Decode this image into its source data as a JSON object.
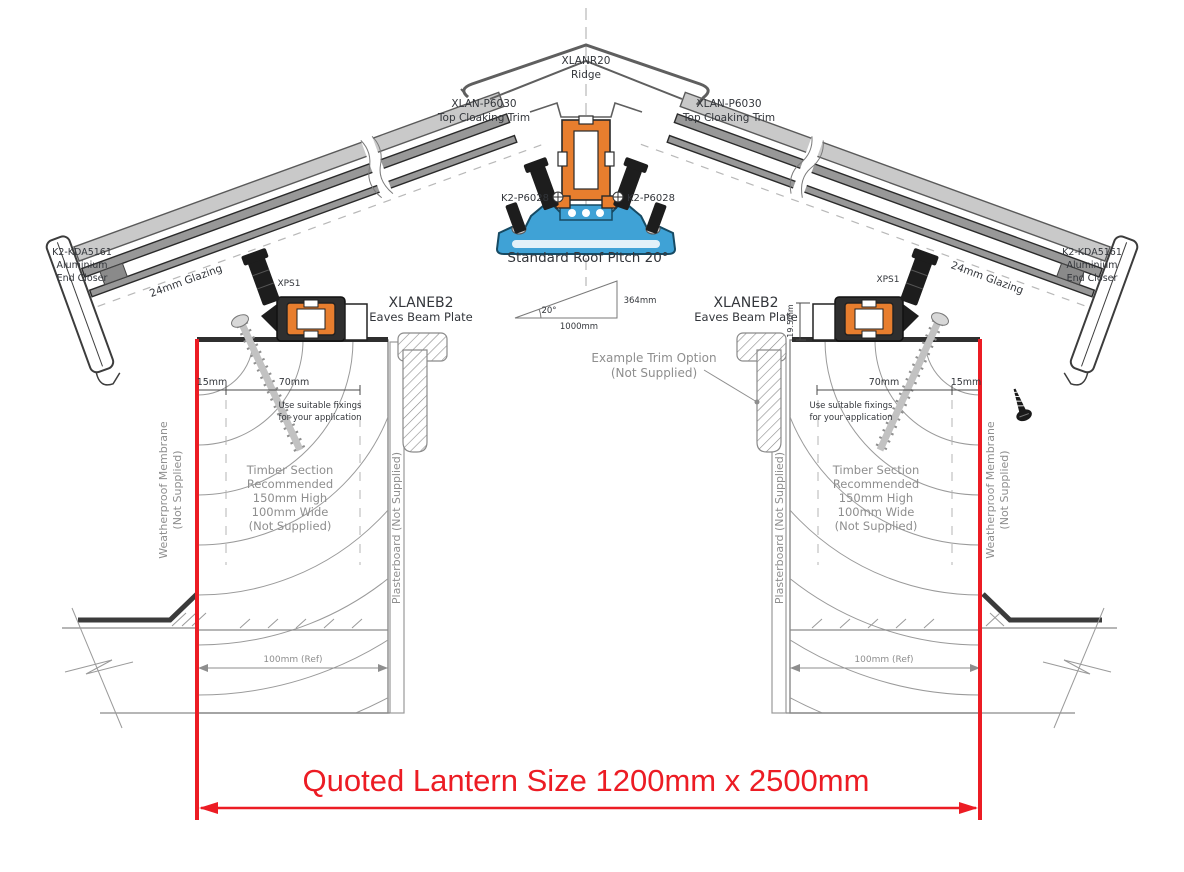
{
  "colors": {
    "red": "#ec1c24",
    "blue": "#3fa2d6",
    "orange": "#e87e2e"
  },
  "title": {
    "quoted_size": "Quoted Lantern Size 1200mm x 2500mm"
  },
  "components": {
    "ridge": {
      "code": "XLANR20",
      "name": "Ridge"
    },
    "top_cloaking": {
      "code": "XLAN-P6030",
      "name": "Top Cloaking Trim"
    },
    "glazing_bar": {
      "code": "K2-P6028"
    },
    "eaves_beam": {
      "code": "XLANEB2",
      "name": "Eaves Beam Plate"
    },
    "fixing_block": {
      "code": "XPS1"
    },
    "end_closer": {
      "code": "K2-KDA5161",
      "line2": "Aluminium",
      "line3": "End Closer"
    },
    "glazing": {
      "name": "24mm Glazing"
    }
  },
  "pitch": {
    "note": "Standard Roof Pitch 20°",
    "angle": "20°",
    "rise": "364mm",
    "run": "1000mm"
  },
  "dimensions": {
    "edge_offset": "15mm",
    "fixing_span": "70mm",
    "beam_height": "19.5mm",
    "timber_ref": "100mm (Ref)"
  },
  "notes": {
    "fixings_line1": "Use suitable fixings",
    "fixings_line2": "for your application",
    "trim_option_line1": "Example Trim Option",
    "trim_option_line2": "(Not Supplied)",
    "timber_lines": [
      "Timber Section",
      "Recommended",
      "150mm High",
      "100mm Wide",
      "(Not Supplied)"
    ],
    "membrane_line1": "Weatherproof Membrane",
    "membrane_line2": "(Not Supplied)",
    "plasterboard": "Plasterboard (Not Supplied)"
  }
}
